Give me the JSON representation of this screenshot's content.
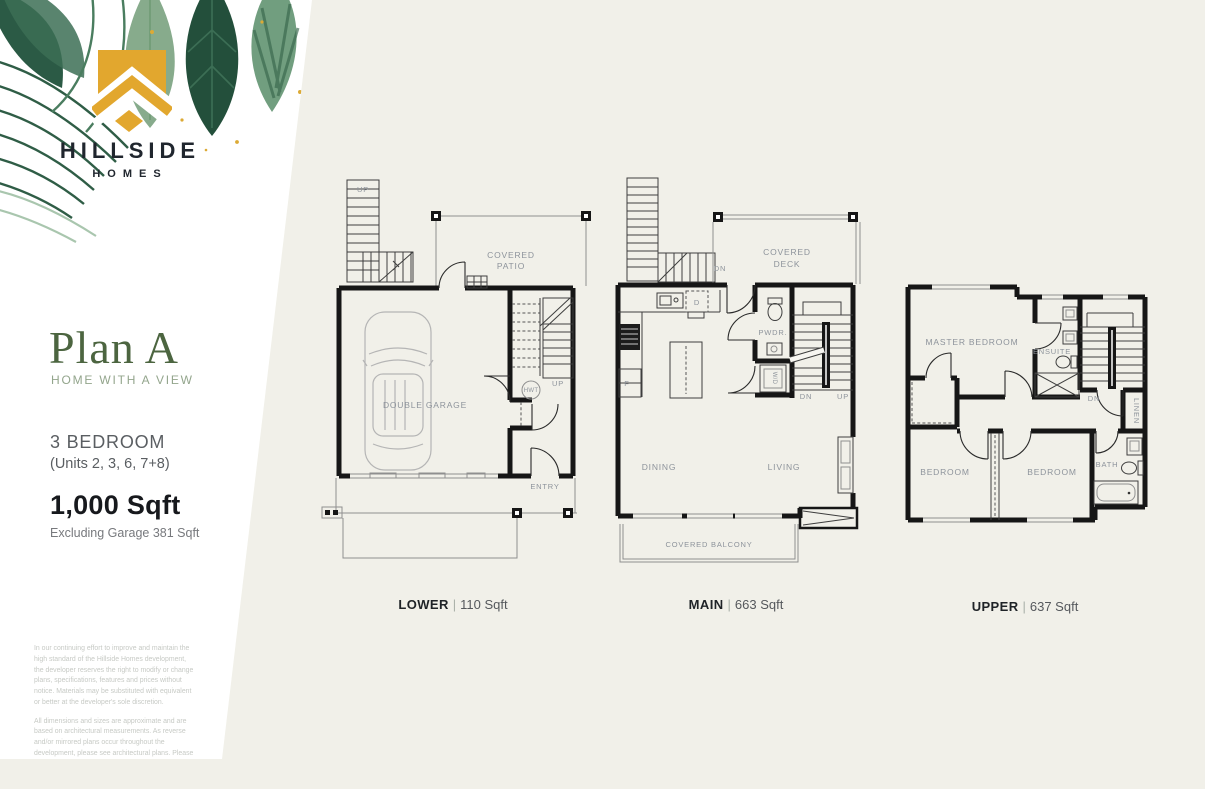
{
  "colors": {
    "background": "#f1f0e9",
    "panel": "#ffffff",
    "gold": "#e2a72e",
    "ink": "#20262e",
    "green": "#4c6540",
    "sage": "#93a58c",
    "plan_label": "#8d939b"
  },
  "brand": {
    "title": "HILLSIDE",
    "subtitle": "HOMES"
  },
  "plan": {
    "title": "Plan A",
    "tagline": "HOME WITH A VIEW",
    "bedrooms": "3 BEDROOM",
    "units": "(Units 2, 3, 6, 7+8)",
    "area": "1,000 Sqft",
    "area_note": "Excluding Garage 381 Sqft"
  },
  "disclaimer": {
    "para1": "In our continuing effort to improve and maintain the high standard of the Hillside Homes development, the developer reserves the right to modify or change plans, specifications, features and prices without notice. Materials may be substituted with equivalent or better at the developer's sole discretion.",
    "para2": "All dimensions and sizes are approximate and are based on architectural measurements. As reverse and/or mirrored plans occur throughout the development, please see architectural plans. Please refer to disclosure statement for specific offering details. E.&O.E."
  },
  "floors": [
    {
      "name": "LOWER",
      "divider": "|",
      "area": "110 Sqft",
      "labels": {
        "stair_up": "UP",
        "patio_line1": "COVERED",
        "patio_line2": "PATIO",
        "garage": "DOUBLE GARAGE",
        "inner_up": "UP",
        "hwt": "HWT",
        "entry": "ENTRY"
      }
    },
    {
      "name": "MAIN",
      "divider": "|",
      "area": "663 Sqft",
      "labels": {
        "deck_line1": "COVERED",
        "deck_line2": "DECK",
        "stair_dn": "DN",
        "dishwasher": "D",
        "fridge": "F",
        "pwdr": "PWDR.",
        "wd": "W/D",
        "dn": "DN",
        "up": "UP",
        "dining": "DINING",
        "living": "LIVING",
        "balcony": "COVERED BALCONY"
      }
    },
    {
      "name": "UPPER",
      "divider": "|",
      "area": "637 Sqft",
      "labels": {
        "master": "MASTER BEDROOM",
        "ensuite": "ENSUITE",
        "dn": "DN",
        "linen": "LINEN",
        "bedroom_left": "BEDROOM",
        "bedroom_right": "BEDROOM",
        "bath": "BATH"
      }
    }
  ]
}
